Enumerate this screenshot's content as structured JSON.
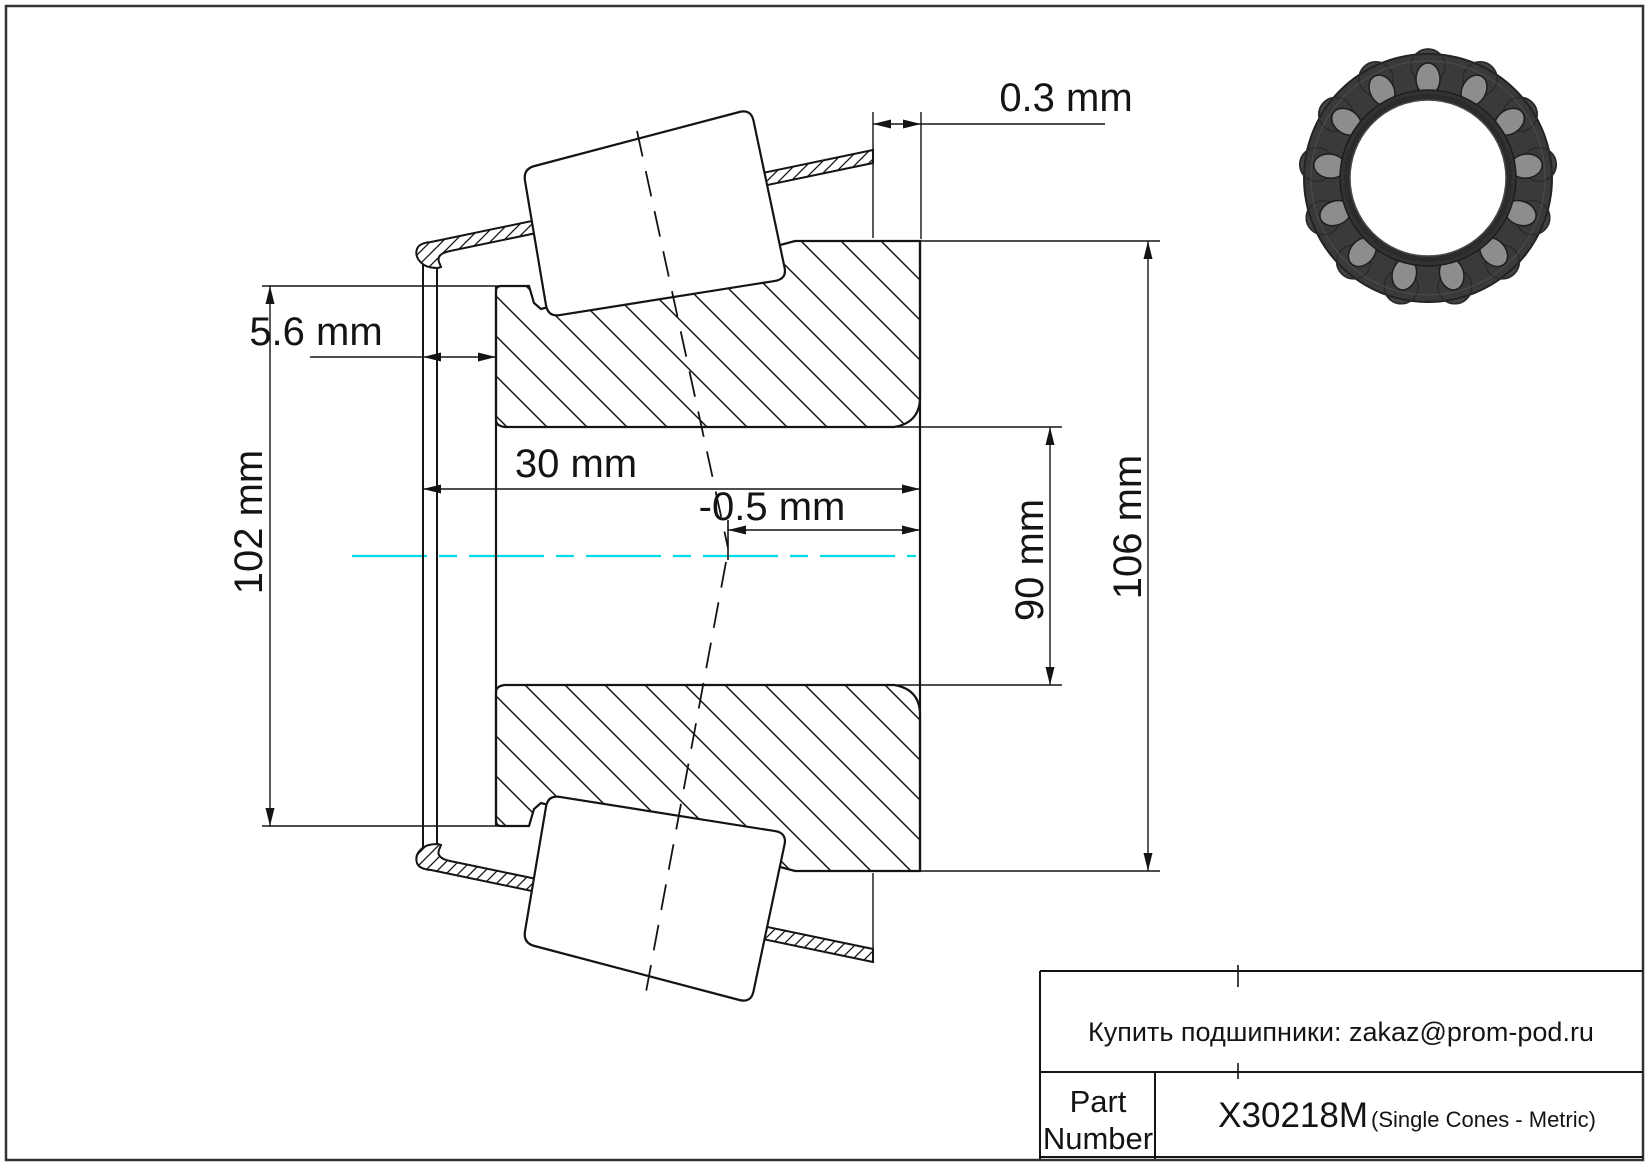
{
  "page": {
    "bg": "#ffffff",
    "border_color": "#333333"
  },
  "drawing": {
    "line_color": "#141414",
    "centerline_color": "#00dce4",
    "dims": {
      "d03": "0.3 mm",
      "d56": "5.6 mm",
      "d30": "30 mm",
      "dneg05": "-0.5 mm",
      "d90": "90 mm",
      "d102": "102 mm",
      "d106": "106 mm"
    }
  },
  "bearing_image": {
    "roller_count": 13,
    "ring_color": "#3a3a3a",
    "bump_color": "#434343",
    "roller_color": "#8d8d8d",
    "edge_color": "#232323",
    "inner_ring_color": "#323232",
    "bore_color": "#2b2b2b"
  },
  "title_block": {
    "contact": "Купить подшипники: zakaz@prom-pod.ru",
    "part_label_line1": "Part",
    "part_label_line2": "Number",
    "part_number": "X30218M",
    "part_type": "(Single Cones - Metric)"
  }
}
